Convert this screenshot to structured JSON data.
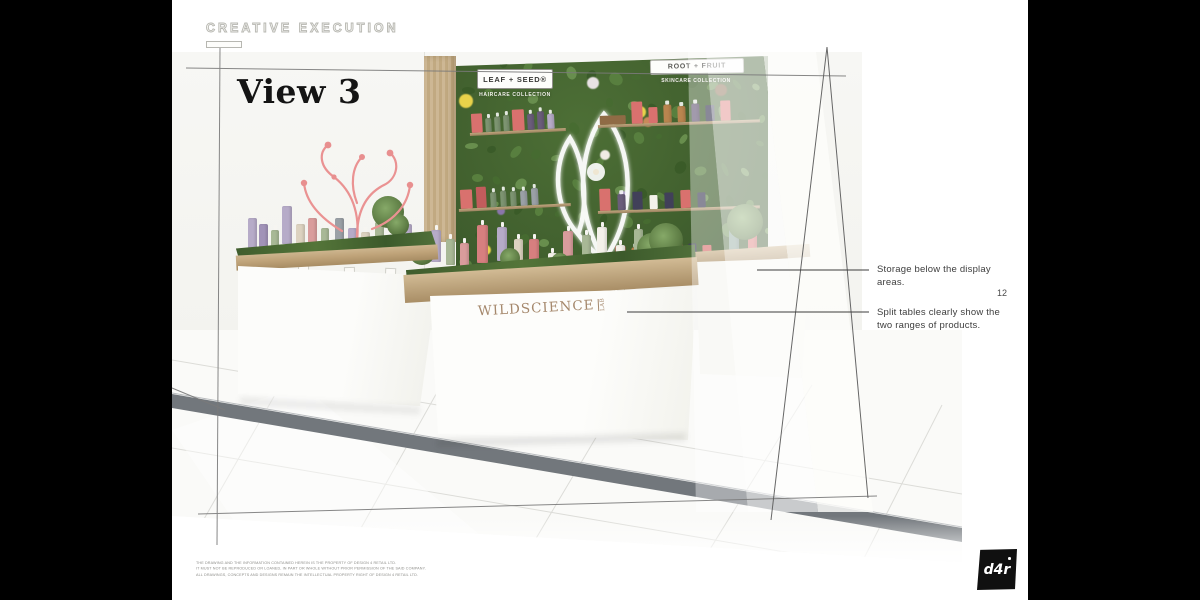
{
  "slide": {
    "kicker": "CREATIVE EXECUTION",
    "title": "View 3",
    "page_number": "12"
  },
  "render": {
    "signs": [
      {
        "title": "LEAF + SEED®",
        "subtitle": "HAIRCARE COLLECTION"
      },
      {
        "title": "ROOT + FRUIT",
        "subtitle": "SKINCARE COLLECTION"
      }
    ],
    "counter_brand": {
      "main": "WILDSCIENCE",
      "lab": "LAB"
    }
  },
  "annotations": [
    {
      "text": "Storage below the display areas."
    },
    {
      "text": "Split tables clearly show the two ranges of products."
    }
  ],
  "footer": {
    "legal_lines": [
      "THE DRAWING AND THE INFORMATION CONTAINED HEREIN IS THE PROPERTY OF DESIGN 4 RETAIL LTD.",
      "IT MUST NOT BE REPRODUCED OR LOANED, IN PART OR WHOLE WITHOUT PRIOR PERMISSION OF THE SAID COMPANY.",
      "ALL DRAWINGS, CONCEPTS AND DESIGNS REMAIN THE INTELLECTUAL PROPERTY RIGHT OF DESIGN 4 RETAIL LTD."
    ],
    "logo_text": "d4r"
  },
  "palette": {
    "coral": "#d9716e",
    "coralDark": "#c25c5c",
    "navy": "#414059",
    "purple": "#6a5d7a",
    "green": "#7d9471",
    "gray": "#9aa0a6",
    "lavender": "#b6abc8",
    "lavenderDark": "#a193b8",
    "sage": "#a8b896",
    "cream": "#dcd2c0",
    "blush": "#d99c9c",
    "pink": "#d77f7f",
    "white": "#f4f1ea",
    "amber": "#b9854f",
    "log": "#8f6b45",
    "teal": "#7f9c8e",
    "flowerPurple": "#7c6a9a",
    "foliage": [
      "#476b31",
      "#5a8140",
      "#3a5a28",
      "#6b9150"
    ],
    "brand_bronze": "#a5886c",
    "frame_line": "#6e6e6e",
    "floor_trim": "#72777c"
  },
  "scene": {
    "flowers": [
      {
        "x": 1,
        "y": 16,
        "c": "#e8d24a",
        "r": 7
      },
      {
        "x": 57,
        "y": 21,
        "c": "#e8d24a",
        "r": 6
      },
      {
        "x": 8,
        "y": 80,
        "c": "#e8d24a",
        "r": 5
      },
      {
        "x": 20,
        "y": 7,
        "c": "#8a76ab",
        "r": 6
      },
      {
        "x": 52,
        "y": 57,
        "c": "#8a76ab",
        "r": 5
      },
      {
        "x": 13,
        "y": 64,
        "c": "#8a76ab",
        "r": 4
      },
      {
        "x": 42,
        "y": 9,
        "c": "#e9e2e4",
        "r": 6
      },
      {
        "x": 60,
        "y": 26,
        "c": "#c98a5a",
        "r": 5
      },
      {
        "x": 83,
        "y": 12,
        "c": "#7a5a3a",
        "r": 6
      },
      {
        "x": 46,
        "y": 40,
        "c": "#f0ece4",
        "r": 5
      }
    ],
    "shelves": [
      {
        "x": 470,
        "y": 136,
        "w": 96,
        "tilt": -3,
        "gap": 3,
        "items": [
          {
            "c": "coral",
            "w": 11,
            "h": 19,
            "t": "box"
          },
          {
            "c": "green",
            "w": 6,
            "h": 14,
            "t": "bottle"
          },
          {
            "c": "green",
            "w": 6,
            "h": 15,
            "t": "bottle"
          },
          {
            "c": "green",
            "w": 6,
            "h": 16,
            "t": "bottle"
          },
          {
            "c": "coral",
            "w": 12,
            "h": 21,
            "t": "box"
          },
          {
            "c": "purple",
            "w": 7,
            "h": 16,
            "t": "bottle"
          },
          {
            "c": "purple",
            "w": 7,
            "h": 18,
            "t": "bottle"
          },
          {
            "c": "lavender",
            "w": 7,
            "h": 15,
            "t": "bottle"
          }
        ]
      },
      {
        "x": 598,
        "y": 128,
        "w": 162,
        "tilt": -2,
        "gap": 6,
        "items": [
          {
            "c": "log",
            "w": 26,
            "h": 9,
            "t": "log"
          },
          {
            "c": "coral",
            "w": 11,
            "h": 22,
            "t": "box"
          },
          {
            "c": "coral",
            "w": 9,
            "h": 16,
            "t": "box"
          },
          {
            "c": "amber",
            "w": 8,
            "h": 18,
            "t": "bottle"
          },
          {
            "c": "amber",
            "w": 8,
            "h": 16,
            "t": "bottle"
          },
          {
            "c": "purple",
            "w": 8,
            "h": 18,
            "t": "bottle"
          },
          {
            "c": "navy",
            "w": 9,
            "h": 16,
            "t": "box"
          },
          {
            "c": "coral",
            "w": 10,
            "h": 20,
            "t": "box"
          }
        ]
      },
      {
        "x": 459,
        "y": 212,
        "w": 112,
        "tilt": -3,
        "gap": 4,
        "items": [
          {
            "c": "coral",
            "w": 12,
            "h": 19,
            "t": "box"
          },
          {
            "c": "coralDark",
            "w": 10,
            "h": 21,
            "t": "box"
          },
          {
            "c": "green",
            "w": 6,
            "h": 15,
            "t": "bottle"
          },
          {
            "c": "green",
            "w": 6,
            "h": 16,
            "t": "bottle"
          },
          {
            "c": "green",
            "w": 6,
            "h": 15,
            "t": "bottle"
          },
          {
            "c": "gray",
            "w": 7,
            "h": 15,
            "t": "bottle"
          },
          {
            "c": "gray",
            "w": 7,
            "h": 17,
            "t": "bottle"
          }
        ]
      },
      {
        "x": 598,
        "y": 214,
        "w": 162,
        "tilt": -2,
        "gap": 7,
        "items": [
          {
            "c": "coral",
            "w": 11,
            "h": 22,
            "t": "box"
          },
          {
            "c": "purple",
            "w": 8,
            "h": 16,
            "t": "bottle"
          },
          {
            "c": "navy",
            "w": 10,
            "h": 18,
            "t": "box"
          },
          {
            "c": "white",
            "w": 8,
            "h": 14,
            "t": "box"
          },
          {
            "c": "navy",
            "w": 9,
            "h": 16,
            "t": "box"
          },
          {
            "c": "coral",
            "w": 10,
            "h": 18,
            "t": "box"
          },
          {
            "c": "navy",
            "w": 8,
            "h": 15,
            "t": "box"
          }
        ]
      },
      {
        "x": 592,
        "y": 266,
        "w": 172,
        "tilt": -2,
        "gap": 6,
        "items": [
          {
            "c": "flowerPurple",
            "w": 16,
            "h": 10,
            "t": "flower"
          },
          {
            "c": "coral",
            "w": 10,
            "h": 16,
            "t": "box"
          },
          {
            "c": "amber",
            "w": 7,
            "h": 14,
            "t": "bottle"
          },
          {
            "c": "amber",
            "w": 7,
            "h": 16,
            "t": "bottle"
          },
          {
            "c": "navy",
            "w": 9,
            "h": 15,
            "t": "box"
          },
          {
            "c": "coral",
            "w": 10,
            "h": 18,
            "t": "box"
          },
          {
            "c": "navy",
            "w": 8,
            "h": 16,
            "t": "box"
          },
          {
            "c": "coral",
            "w": 9,
            "h": 14,
            "t": "box"
          }
        ]
      }
    ],
    "left_table_bottles": [
      {
        "x": 252,
        "b": 248,
        "w": 9,
        "h": 30,
        "c": "lavender"
      },
      {
        "x": 263,
        "b": 250,
        "w": 9,
        "h": 26,
        "c": "lavenderDark"
      },
      {
        "x": 275,
        "b": 252,
        "w": 8,
        "h": 22,
        "c": "sage"
      },
      {
        "x": 287,
        "b": 244,
        "w": 10,
        "h": 38,
        "c": "lavender"
      },
      {
        "x": 300,
        "b": 250,
        "w": 9,
        "h": 26,
        "c": "cream"
      },
      {
        "x": 312,
        "b": 248,
        "w": 9,
        "h": 30,
        "c": "blush"
      },
      {
        "x": 325,
        "b": 252,
        "w": 8,
        "h": 24,
        "c": "sage"
      },
      {
        "x": 339,
        "b": 248,
        "w": 9,
        "h": 30,
        "c": "gray"
      },
      {
        "x": 352,
        "b": 252,
        "w": 9,
        "h": 24,
        "c": "lavender"
      },
      {
        "x": 365,
        "b": 254,
        "w": 9,
        "h": 22,
        "c": "cream"
      },
      {
        "x": 379,
        "b": 250,
        "w": 9,
        "h": 28,
        "c": "sage"
      },
      {
        "x": 407,
        "b": 250,
        "w": 9,
        "h": 26,
        "c": "lavender"
      }
    ],
    "main_table_bottles": [
      {
        "x": 436,
        "b": 262,
        "w": 10,
        "h": 32,
        "c": "lavender"
      },
      {
        "x": 450,
        "b": 265,
        "w": 9,
        "h": 26,
        "c": "sage"
      },
      {
        "x": 464,
        "b": 267,
        "w": 9,
        "h": 24,
        "c": "blush"
      },
      {
        "x": 482,
        "b": 263,
        "w": 11,
        "h": 38,
        "c": "pink"
      },
      {
        "x": 502,
        "b": 261,
        "w": 10,
        "h": 34,
        "c": "lavender"
      },
      {
        "x": 518,
        "b": 265,
        "w": 9,
        "h": 26,
        "c": "cream"
      },
      {
        "x": 534,
        "b": 269,
        "w": 10,
        "h": 30,
        "c": "pink"
      },
      {
        "x": 552,
        "b": 271,
        "w": 9,
        "h": 18,
        "c": "white"
      },
      {
        "x": 568,
        "b": 265,
        "w": 10,
        "h": 34,
        "c": "blush"
      },
      {
        "x": 586,
        "b": 263,
        "w": 9,
        "h": 28,
        "c": "sage"
      },
      {
        "x": 602,
        "b": 261,
        "w": 10,
        "h": 34,
        "c": "white"
      },
      {
        "x": 620,
        "b": 265,
        "w": 9,
        "h": 20,
        "c": "white"
      },
      {
        "x": 638,
        "b": 259,
        "w": 9,
        "h": 30,
        "c": "sage"
      }
    ],
    "right_table_bottles": [
      {
        "x": 734,
        "b": 250,
        "w": 10,
        "h": 26,
        "c": "teal"
      },
      {
        "x": 752,
        "b": 252,
        "w": 9,
        "h": 22,
        "c": "coral"
      }
    ],
    "cards": [
      {
        "x": 256,
        "y": 258,
        "r": -2
      },
      {
        "x": 298,
        "y": 263,
        "r": 1
      },
      {
        "x": 344,
        "y": 267,
        "r": -1
      },
      {
        "x": 385,
        "y": 268,
        "r": 2
      },
      {
        "x": 460,
        "y": 278,
        "r": -2
      },
      {
        "x": 516,
        "y": 284,
        "r": 1
      },
      {
        "x": 564,
        "y": 288,
        "r": -1
      },
      {
        "x": 614,
        "y": 282,
        "r": 2
      }
    ],
    "plants": [
      {
        "x": 388,
        "y": 212,
        "r": 16
      },
      {
        "x": 398,
        "y": 225,
        "r": 11
      },
      {
        "x": 422,
        "y": 252,
        "r": 13
      },
      {
        "x": 510,
        "y": 258,
        "r": 10
      },
      {
        "x": 560,
        "y": 262,
        "r": 9
      },
      {
        "x": 652,
        "y": 248,
        "r": 15
      },
      {
        "x": 666,
        "y": 240,
        "r": 17
      },
      {
        "x": 745,
        "y": 222,
        "r": 18
      }
    ],
    "pots": [
      {
        "x": 392,
        "y": 246,
        "w": 16,
        "h": 12
      },
      {
        "x": 414,
        "y": 250,
        "w": 13,
        "h": 10
      }
    ],
    "stands": [
      {
        "x": 478,
        "y": 265,
        "w": 16
      },
      {
        "x": 532,
        "y": 271,
        "w": 14
      },
      {
        "x": 584,
        "y": 266,
        "w": 15
      },
      {
        "x": 634,
        "y": 261,
        "w": 13
      }
    ]
  }
}
